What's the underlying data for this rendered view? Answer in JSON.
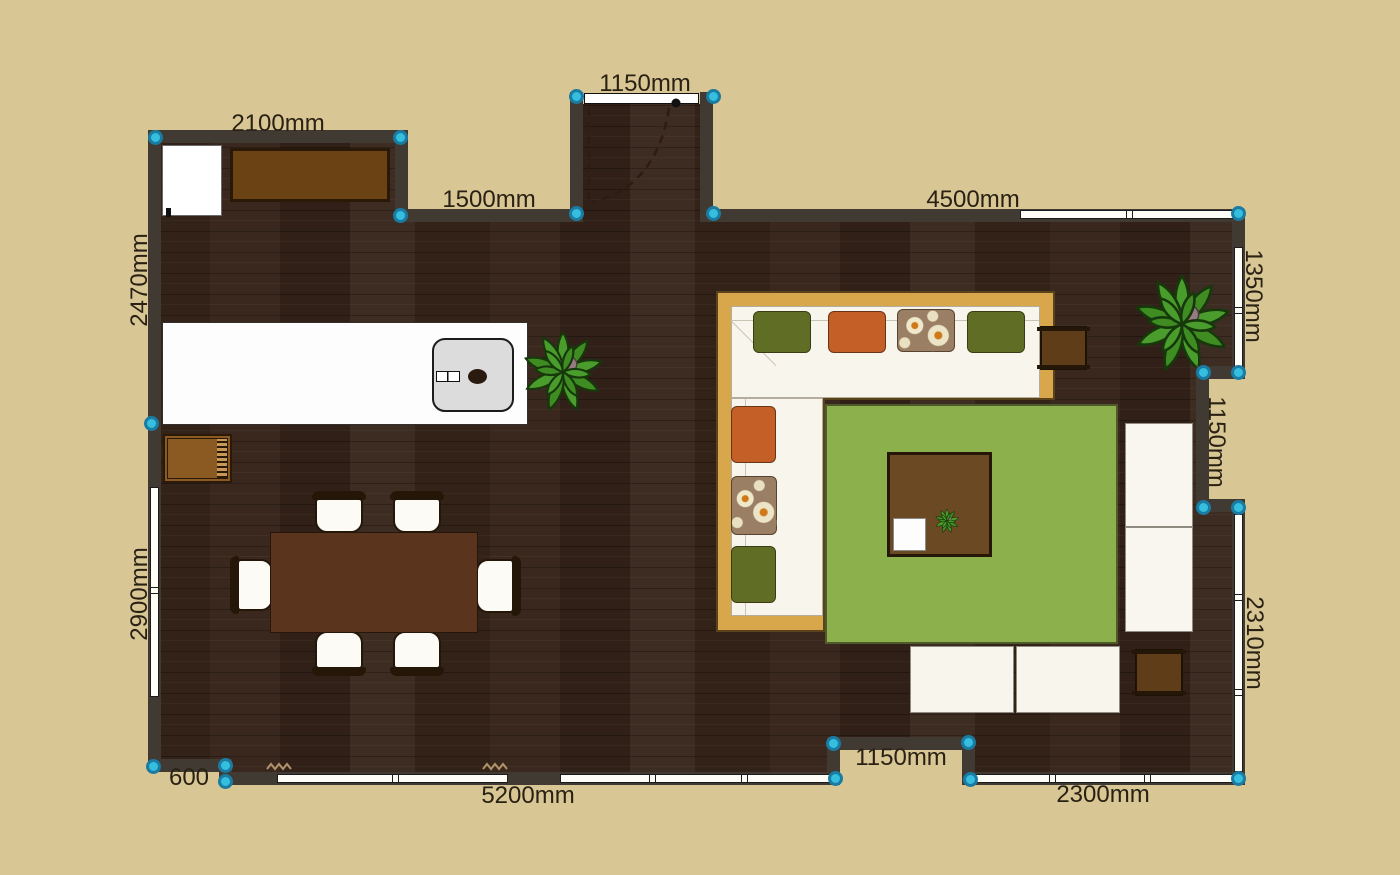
{
  "canvas": {
    "width": 1400,
    "height": 875,
    "background": "#d8c694"
  },
  "colors": {
    "wall": "#403a33",
    "floor_base": "#36241a",
    "marker_fill": "#35bede",
    "marker_ring": "#1a7ca3",
    "label_text": "#2a2115",
    "window_white": "#fffdf8",
    "sofa_frame": "#d8a64b",
    "sofa_frame_edge": "#5a431a",
    "cushion": "#f8f5ed",
    "pillow_olive": "#5f6e24",
    "pillow_orange": "#c55f28",
    "pillow_floral_base": "#9b7f64",
    "rug": "#8cb14c",
    "coffee_table": "#6b4a23",
    "dining_table": "#5b341e",
    "counter": "#6b4213",
    "side_table": "#5f3d18",
    "cart": "#8a5a22",
    "plant_leaf": "#4a9d2c",
    "plant_leaf_dark": "#3f8c22",
    "plant_pot": "#977a82"
  },
  "dimension_labels": [
    {
      "text": "2100mm",
      "x": 278,
      "y": 124,
      "rotation": 0
    },
    {
      "text": "1150mm",
      "x": 645,
      "y": 84,
      "rotation": 0
    },
    {
      "text": "1500mm",
      "x": 489,
      "y": 200,
      "rotation": 0
    },
    {
      "text": "4500mm",
      "x": 973,
      "y": 200,
      "rotation": 0
    },
    {
      "text": "2470mm",
      "x": 140,
      "y": 280,
      "rotation": -90
    },
    {
      "text": "1350mm",
      "x": 1253,
      "y": 296,
      "rotation": 90
    },
    {
      "text": "1150mm",
      "x": 1216,
      "y": 442,
      "rotation": 90
    },
    {
      "text": "2900mm",
      "x": 140,
      "y": 594,
      "rotation": -90
    },
    {
      "text": "2310mm",
      "x": 1254,
      "y": 643,
      "rotation": 90
    },
    {
      "text": "600",
      "x": 189,
      "y": 778,
      "rotation": 0
    },
    {
      "text": "5200mm",
      "x": 528,
      "y": 796,
      "rotation": 0
    },
    {
      "text": "1150mm",
      "x": 901,
      "y": 758,
      "rotation": 0
    },
    {
      "text": "2300mm",
      "x": 1103,
      "y": 795,
      "rotation": 0
    }
  ],
  "floor": {
    "polygon": "161 143,395 143,395 222,583 222,583 104,700 104,700 222,1232 222,1232 366,1196 366,1196 512,1232 512,1232 772,975 772,975 737,827 737,827 772,232 772,232 759,161 759"
  },
  "walls": [
    [
      148,
      130,
      260,
      13
    ],
    [
      395,
      130,
      13,
      92
    ],
    [
      395,
      209,
      188,
      13
    ],
    [
      570,
      92,
      13,
      130
    ],
    [
      700,
      92,
      13,
      130
    ],
    [
      700,
      209,
      545,
      13
    ],
    [
      1232,
      209,
      13,
      170
    ],
    [
      1196,
      366,
      49,
      13
    ],
    [
      1196,
      366,
      13,
      146
    ],
    [
      1196,
      499,
      49,
      13
    ],
    [
      1232,
      499,
      13,
      286
    ],
    [
      962,
      772,
      283,
      13
    ],
    [
      962,
      737,
      13,
      48
    ],
    [
      827,
      737,
      148,
      13
    ],
    [
      827,
      737,
      13,
      48
    ],
    [
      219,
      772,
      621,
      13
    ],
    [
      148,
      759,
      84,
      13
    ],
    [
      219,
      759,
      13,
      26
    ],
    [
      148,
      130,
      13,
      642
    ]
  ],
  "windows": [
    {
      "x": 150,
      "y": 487,
      "w": 9,
      "h": 210,
      "ticks": [
        101
      ]
    },
    {
      "x": 1020,
      "y": 210,
      "w": 216,
      "h": 9,
      "ticks": [
        107
      ]
    },
    {
      "x": 1234,
      "y": 247,
      "w": 9,
      "h": 122,
      "ticks": [
        61
      ]
    },
    {
      "x": 1234,
      "y": 514,
      "w": 9,
      "h": 258,
      "ticks": [
        81,
        176
      ]
    },
    {
      "x": 969,
      "y": 774,
      "w": 268,
      "h": 9,
      "ticks": [
        81,
        176
      ]
    },
    {
      "x": 277,
      "y": 774,
      "w": 231,
      "h": 9,
      "ticks": [
        116
      ]
    },
    {
      "x": 560,
      "y": 774,
      "w": 273,
      "h": 9,
      "ticks": [
        90,
        182
      ]
    }
  ],
  "markers": [
    [
      155,
      137
    ],
    [
      400,
      137
    ],
    [
      400,
      215
    ],
    [
      576,
      96
    ],
    [
      713,
      96
    ],
    [
      576,
      213
    ],
    [
      713,
      213
    ],
    [
      1238,
      213
    ],
    [
      1203,
      372
    ],
    [
      1238,
      372
    ],
    [
      1203,
      507
    ],
    [
      1238,
      507
    ],
    [
      1238,
      778
    ],
    [
      970,
      779
    ],
    [
      968,
      742
    ],
    [
      835,
      778
    ],
    [
      833,
      743
    ],
    [
      225,
      765
    ],
    [
      225,
      781
    ],
    [
      153,
      766
    ],
    [
      151,
      423
    ]
  ],
  "door": {
    "threshold": [
      584,
      93,
      115,
      11
    ],
    "svg_box": [
      560,
      85,
      160,
      140
    ],
    "leaf_path": "M29,23 L29,117",
    "arc_path": "M109,23 Q97,101 33,117",
    "hinge": [
      116,
      18
    ]
  },
  "furniture": {
    "fridge": [
      162,
      145,
      60,
      71
    ],
    "counter": [
      230,
      148,
      160,
      54
    ],
    "island": [
      162,
      322,
      366,
      103
    ],
    "sink": [
      432,
      338,
      82,
      74
    ],
    "cart": [
      163,
      434,
      69,
      49
    ],
    "dining_table": [
      270,
      532,
      208,
      101
    ],
    "chairs": [
      [
        312,
        491,
        54,
        42,
        "up"
      ],
      [
        390,
        491,
        54,
        42,
        "up"
      ],
      [
        312,
        631,
        54,
        45,
        "down"
      ],
      [
        390,
        631,
        54,
        45,
        "down"
      ],
      [
        230,
        556,
        43,
        58,
        "left"
      ],
      [
        476,
        556,
        45,
        60,
        "right"
      ]
    ],
    "sofa": {
      "frame": [
        718,
        293,
        335,
        337
      ],
      "arm": 105,
      "seat_top": [
        731,
        306,
        309,
        92
      ],
      "seat_left": [
        731,
        398,
        92,
        218
      ]
    },
    "pillows": [
      [
        753,
        311,
        58,
        42,
        "olive"
      ],
      [
        828,
        311,
        58,
        42,
        "orange"
      ],
      [
        897,
        309,
        58,
        43,
        "floral"
      ],
      [
        967,
        311,
        58,
        42,
        "olive"
      ],
      [
        731,
        406,
        45,
        57,
        "orange"
      ],
      [
        731,
        476,
        46,
        59,
        "floral"
      ],
      [
        731,
        546,
        45,
        57,
        "olive"
      ]
    ],
    "rug": [
      825,
      404,
      293,
      240
    ],
    "coffee_table": [
      887,
      452,
      105,
      105
    ],
    "tray": [
      893,
      518,
      33,
      33
    ],
    "ottomans": [
      [
        910,
        646,
        104,
        67
      ],
      [
        1016,
        646,
        104,
        67
      ]
    ],
    "white_units": [
      [
        1125,
        423,
        68,
        104
      ],
      [
        1125,
        527,
        68,
        105
      ]
    ],
    "side_tables": [
      [
        1040,
        326,
        47,
        44
      ],
      [
        1135,
        649,
        48,
        47
      ]
    ],
    "plants": [
      {
        "cx": 563,
        "cy": 372,
        "s": 86
      },
      {
        "cx": 1182,
        "cy": 324,
        "s": 104
      },
      {
        "cx": 947,
        "cy": 521,
        "s": 26
      }
    ],
    "squiggles": [
      [
        266,
        762
      ],
      [
        482,
        762
      ]
    ]
  }
}
